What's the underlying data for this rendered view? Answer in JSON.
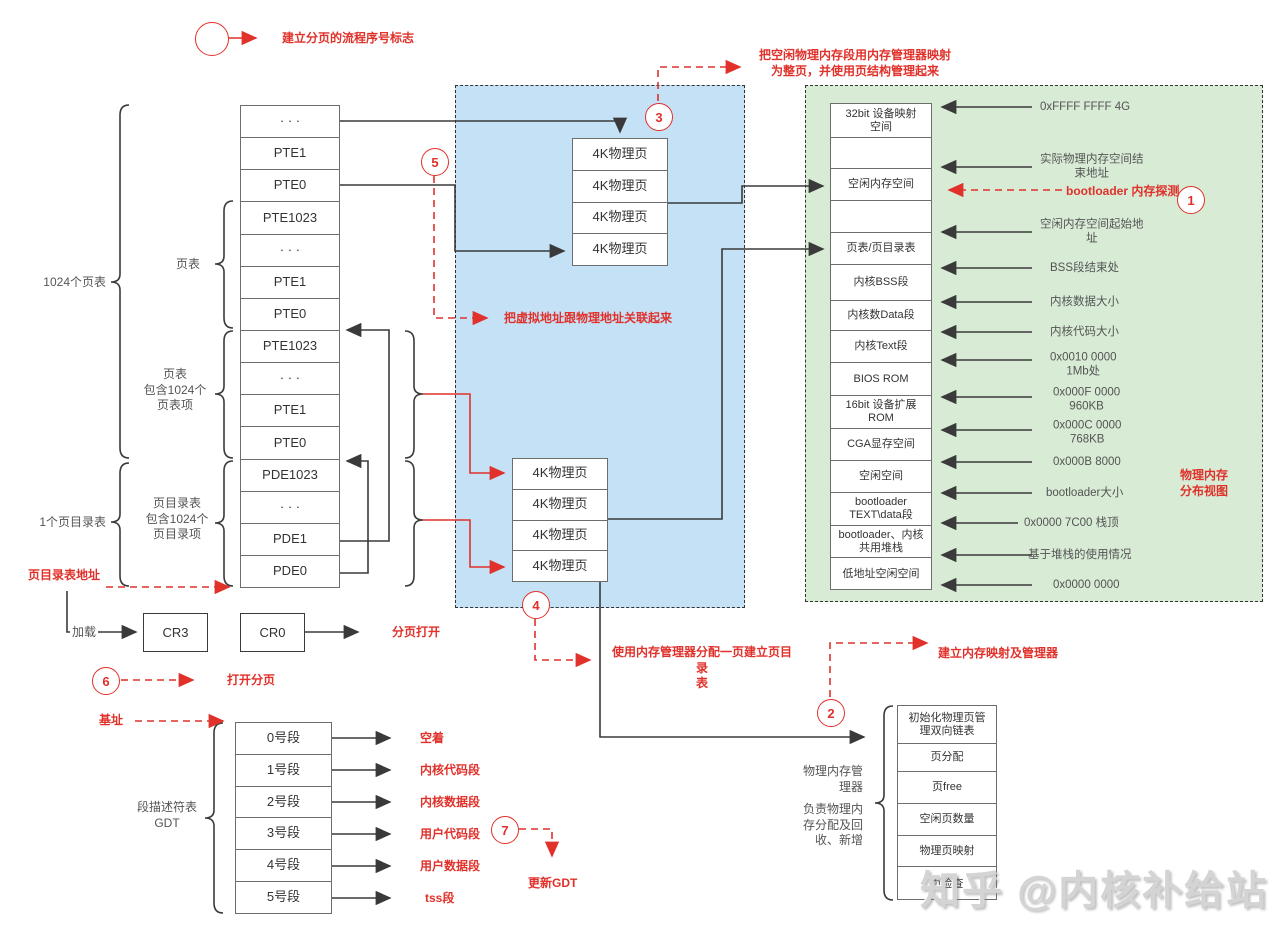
{
  "colors": {
    "accent_red": "#e0312b",
    "region_blue": "#c5e1f6",
    "region_green": "#d7ebd5"
  },
  "circles": [
    "1",
    "2",
    "3",
    "4",
    "5",
    "6",
    "7"
  ],
  "legend_note": "建立分页的流程序号标志",
  "left_table": {
    "rows": [
      "· · ·",
      "PTE1",
      "PTE0",
      "PTE1023",
      "· · ·",
      "PTE1",
      "PTE0",
      "PTE1023",
      "· · ·",
      "PTE1",
      "PTE0",
      "PDE1023",
      "· · ·",
      "PDE1",
      "PDE0"
    ]
  },
  "labels": {
    "pagetables_1024": "1024个页表",
    "pagetable": "页表",
    "pagetable_detail": "页表\n包含1024个\n页表项",
    "one_pgdir": "1个页目录表",
    "pgdir_detail": "页目录表\n包含1024个\n页目录项",
    "gdt_brace": "段描述符表\nGDT",
    "load": "加载",
    "mgr_side1": "物理内存管\n理器",
    "mgr_side2": "负责物理内\n存分配及回\n收、新增"
  },
  "stacks": {
    "label": "4K物理页"
  },
  "memory_map": {
    "rows": [
      "32bit 设备映射\n空间",
      "",
      "空闲内存空间",
      "",
      "页表/页目录表",
      "内核BSS段",
      "内核数Data段",
      "内核Text段",
      "BIOS ROM",
      "16bit 设备扩展\nROM",
      "CGA显存空间",
      "空闲空间",
      "bootloader\nTEXT\\data段",
      "bootloader、内核\n共用堆栈",
      "低地址空闲空间"
    ],
    "markers": [
      "0xFFFF FFFF 4G",
      "实际物理内存空间结\n束地址",
      "空闲内存空间起始地\n址",
      "BSS段结束处",
      "内核数据大小",
      "内核代码大小",
      "0x0010 0000\n1Mb处",
      "0x000F 0000\n960KB",
      "0x000C 0000\n768KB",
      "0x000B 8000",
      "bootloader大小",
      "0x0000 7C00 栈顶",
      "基于堆栈的使用情况",
      "0x0000 0000"
    ]
  },
  "registers": {
    "cr3": "CR3",
    "cr0": "CR0"
  },
  "gdt": {
    "rows": [
      "0号段",
      "1号段",
      "2号段",
      "3号段",
      "4号段",
      "5号段"
    ],
    "seg_labels": [
      "空着",
      "内核代码段",
      "内核数据段",
      "用户代码段",
      "用户数据段",
      "tss段"
    ]
  },
  "manager": {
    "rows": [
      "初始化物理页管\n理双向链表",
      "页分配",
      "页free",
      "空闲页数量",
      "物理页映射",
      "页检查"
    ]
  },
  "red_notes": {
    "map_free_pages": "把空闲物理内存段用内存管理器映射\n为整页，并使用页结构管理起来",
    "bootloader_probe": "bootloader 内存探测",
    "phys_view": "物理内存\n分布视图",
    "link_va_pa": "把虚拟地址跟物理地址关联起来",
    "pgdir_addr": "页目录表地址",
    "paging_open": "分页打开",
    "open_paging": "打开分页",
    "base_addr": "基址",
    "alloc_pgdir": "使用内存管理器分配一页建立页目录\n表",
    "build_mapping": "建立内存映射及管理器",
    "update_gdt": "更新GDT"
  },
  "watermark": "知乎 @内核补给站"
}
